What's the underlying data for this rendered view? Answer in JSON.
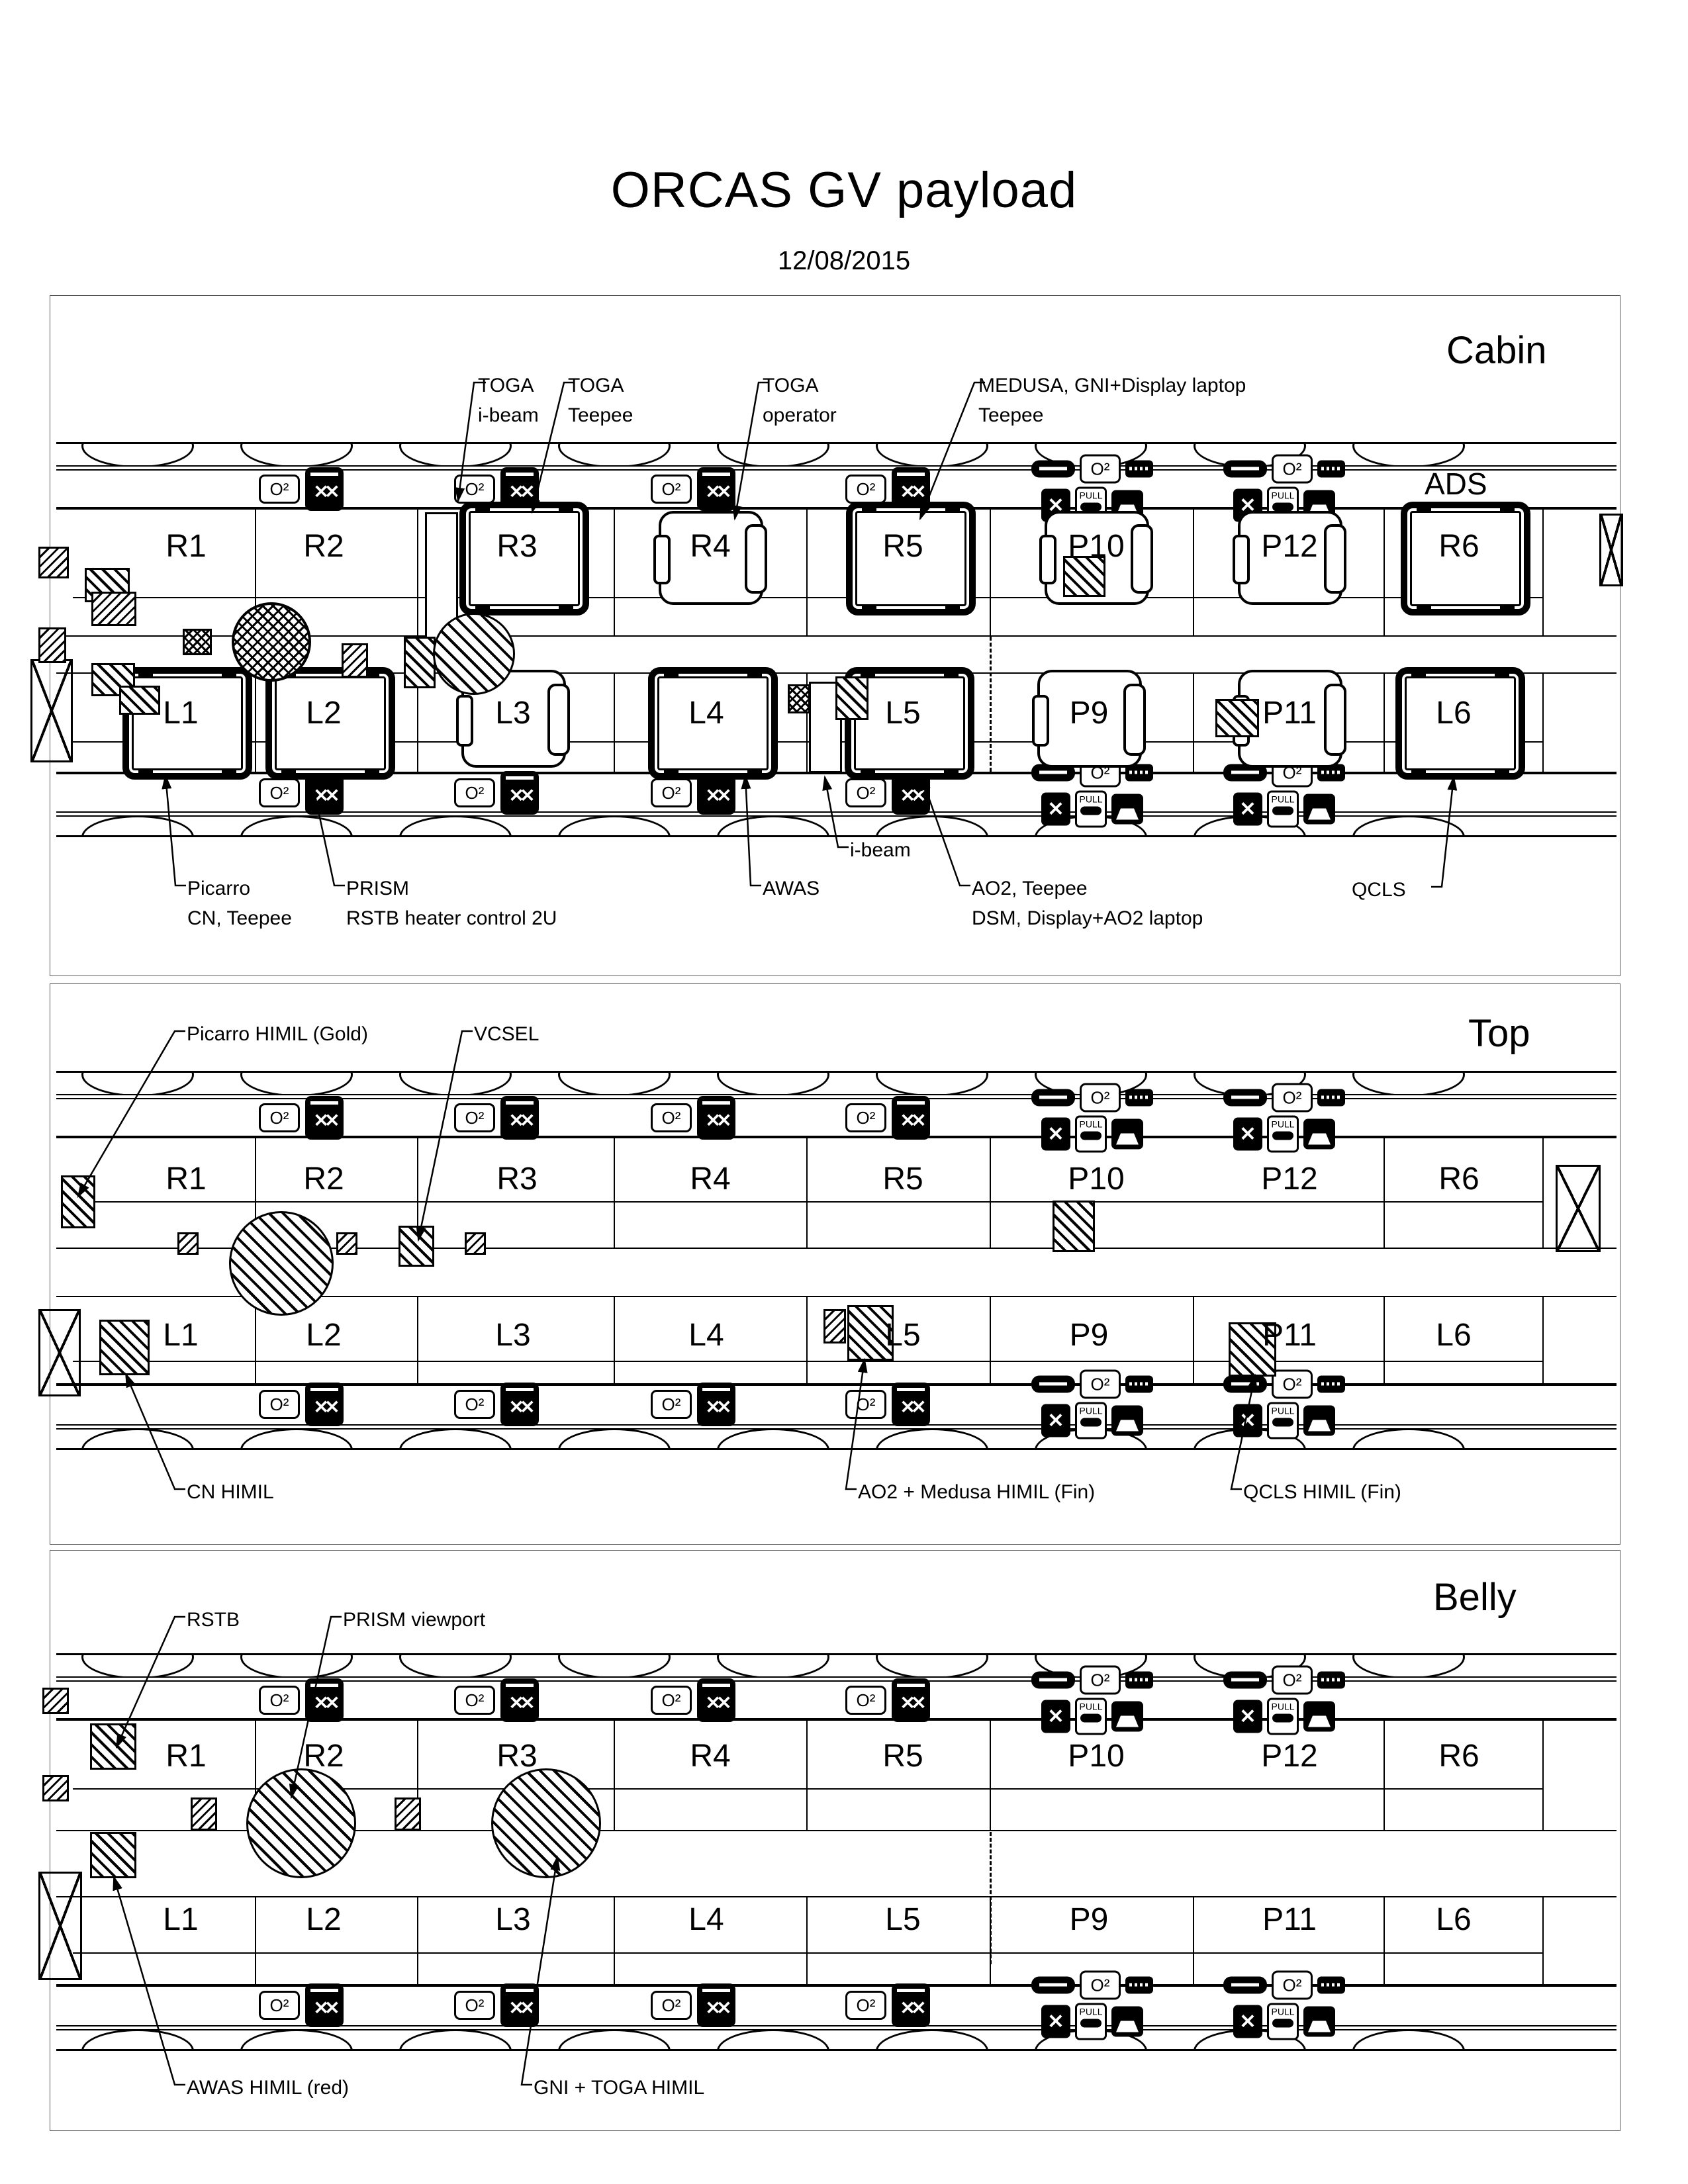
{
  "page": {
    "title": "ORCAS GV payload",
    "date": "12/08/2015"
  },
  "icons": {
    "oxygen_label": "O²",
    "pull_label": "PULL"
  },
  "sections": {
    "cabin": {
      "label": "Cabin",
      "ads_label": "ADS",
      "r_row": [
        "R1",
        "R2",
        "R3",
        "R4",
        "R5",
        "P10",
        "P12",
        "R6"
      ],
      "l_row": [
        "L1",
        "L2",
        "L3",
        "L4",
        "L5",
        "P9",
        "P11",
        "L6"
      ],
      "annotations": {
        "toga_ibeam": "TOGA\ni-beam",
        "toga_teepee": "TOGA\nTeepee",
        "toga_operator": "TOGA\noperator",
        "medusa": "MEDUSA, GNI+Display laptop\nTeepee",
        "picarro": "Picarro\nCN, Teepee",
        "prism": "PRISM\nRSTB heater control 2U",
        "awas": "AWAS",
        "ibeam": "i-beam",
        "ao2": "AO2, Teepee\nDSM, Display+AO2 laptop",
        "qcls": "QCLS"
      }
    },
    "top": {
      "label": "Top",
      "r_row": [
        "R1",
        "R2",
        "R3",
        "R4",
        "R5",
        "P10",
        "P12",
        "R6"
      ],
      "l_row": [
        "L1",
        "L2",
        "L3",
        "L4",
        "L5",
        "P9",
        "P11",
        "L6"
      ],
      "annotations": {
        "picarro_himil": "Picarro HIMIL (Gold)",
        "vcsel": "VCSEL",
        "cn_himil": "CN HIMIL",
        "ao2_medusa": "AO2 + Medusa HIMIL (Fin)",
        "qcls_himil": "QCLS HIMIL (Fin)"
      }
    },
    "belly": {
      "label": "Belly",
      "r_row": [
        "R1",
        "R2",
        "R3",
        "R4",
        "R5",
        "P10",
        "P12",
        "R6"
      ],
      "l_row": [
        "L1",
        "L2",
        "L3",
        "L4",
        "L5",
        "P9",
        "P11",
        "L6"
      ],
      "annotations": {
        "rstb": "RSTB",
        "prism_viewport": "PRISM viewport",
        "awas_himil": "AWAS HIMIL (red)",
        "gni_toga": "GNI + TOGA HIMIL"
      }
    }
  }
}
